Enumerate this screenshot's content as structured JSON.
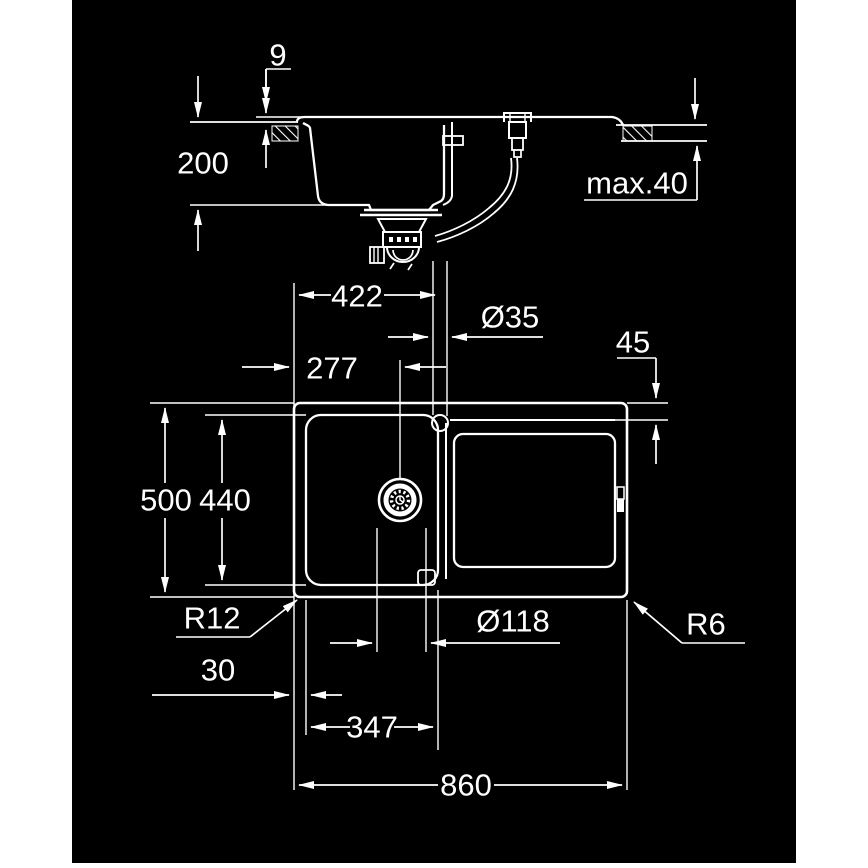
{
  "drawing": {
    "background_color": "#000000",
    "line_color": "#ffffff",
    "section_view": {
      "rim_height": "9",
      "bowl_depth": "200",
      "max_counter_thickness": "max.40"
    },
    "plan_view": {
      "tap_hole_from_left": "422",
      "tap_hole_diameter": "Ø35",
      "drainer_edge_offset": "45",
      "drain_center_from_left": "277",
      "overall_depth": "500",
      "inner_depth": "440",
      "corner_radius_bottom_left": "R12",
      "drain_cutout_diameter": "Ø118",
      "corner_radius_bottom_right": "R6",
      "rim_width": "30",
      "bowl_width": "347",
      "overall_width": "860"
    }
  }
}
